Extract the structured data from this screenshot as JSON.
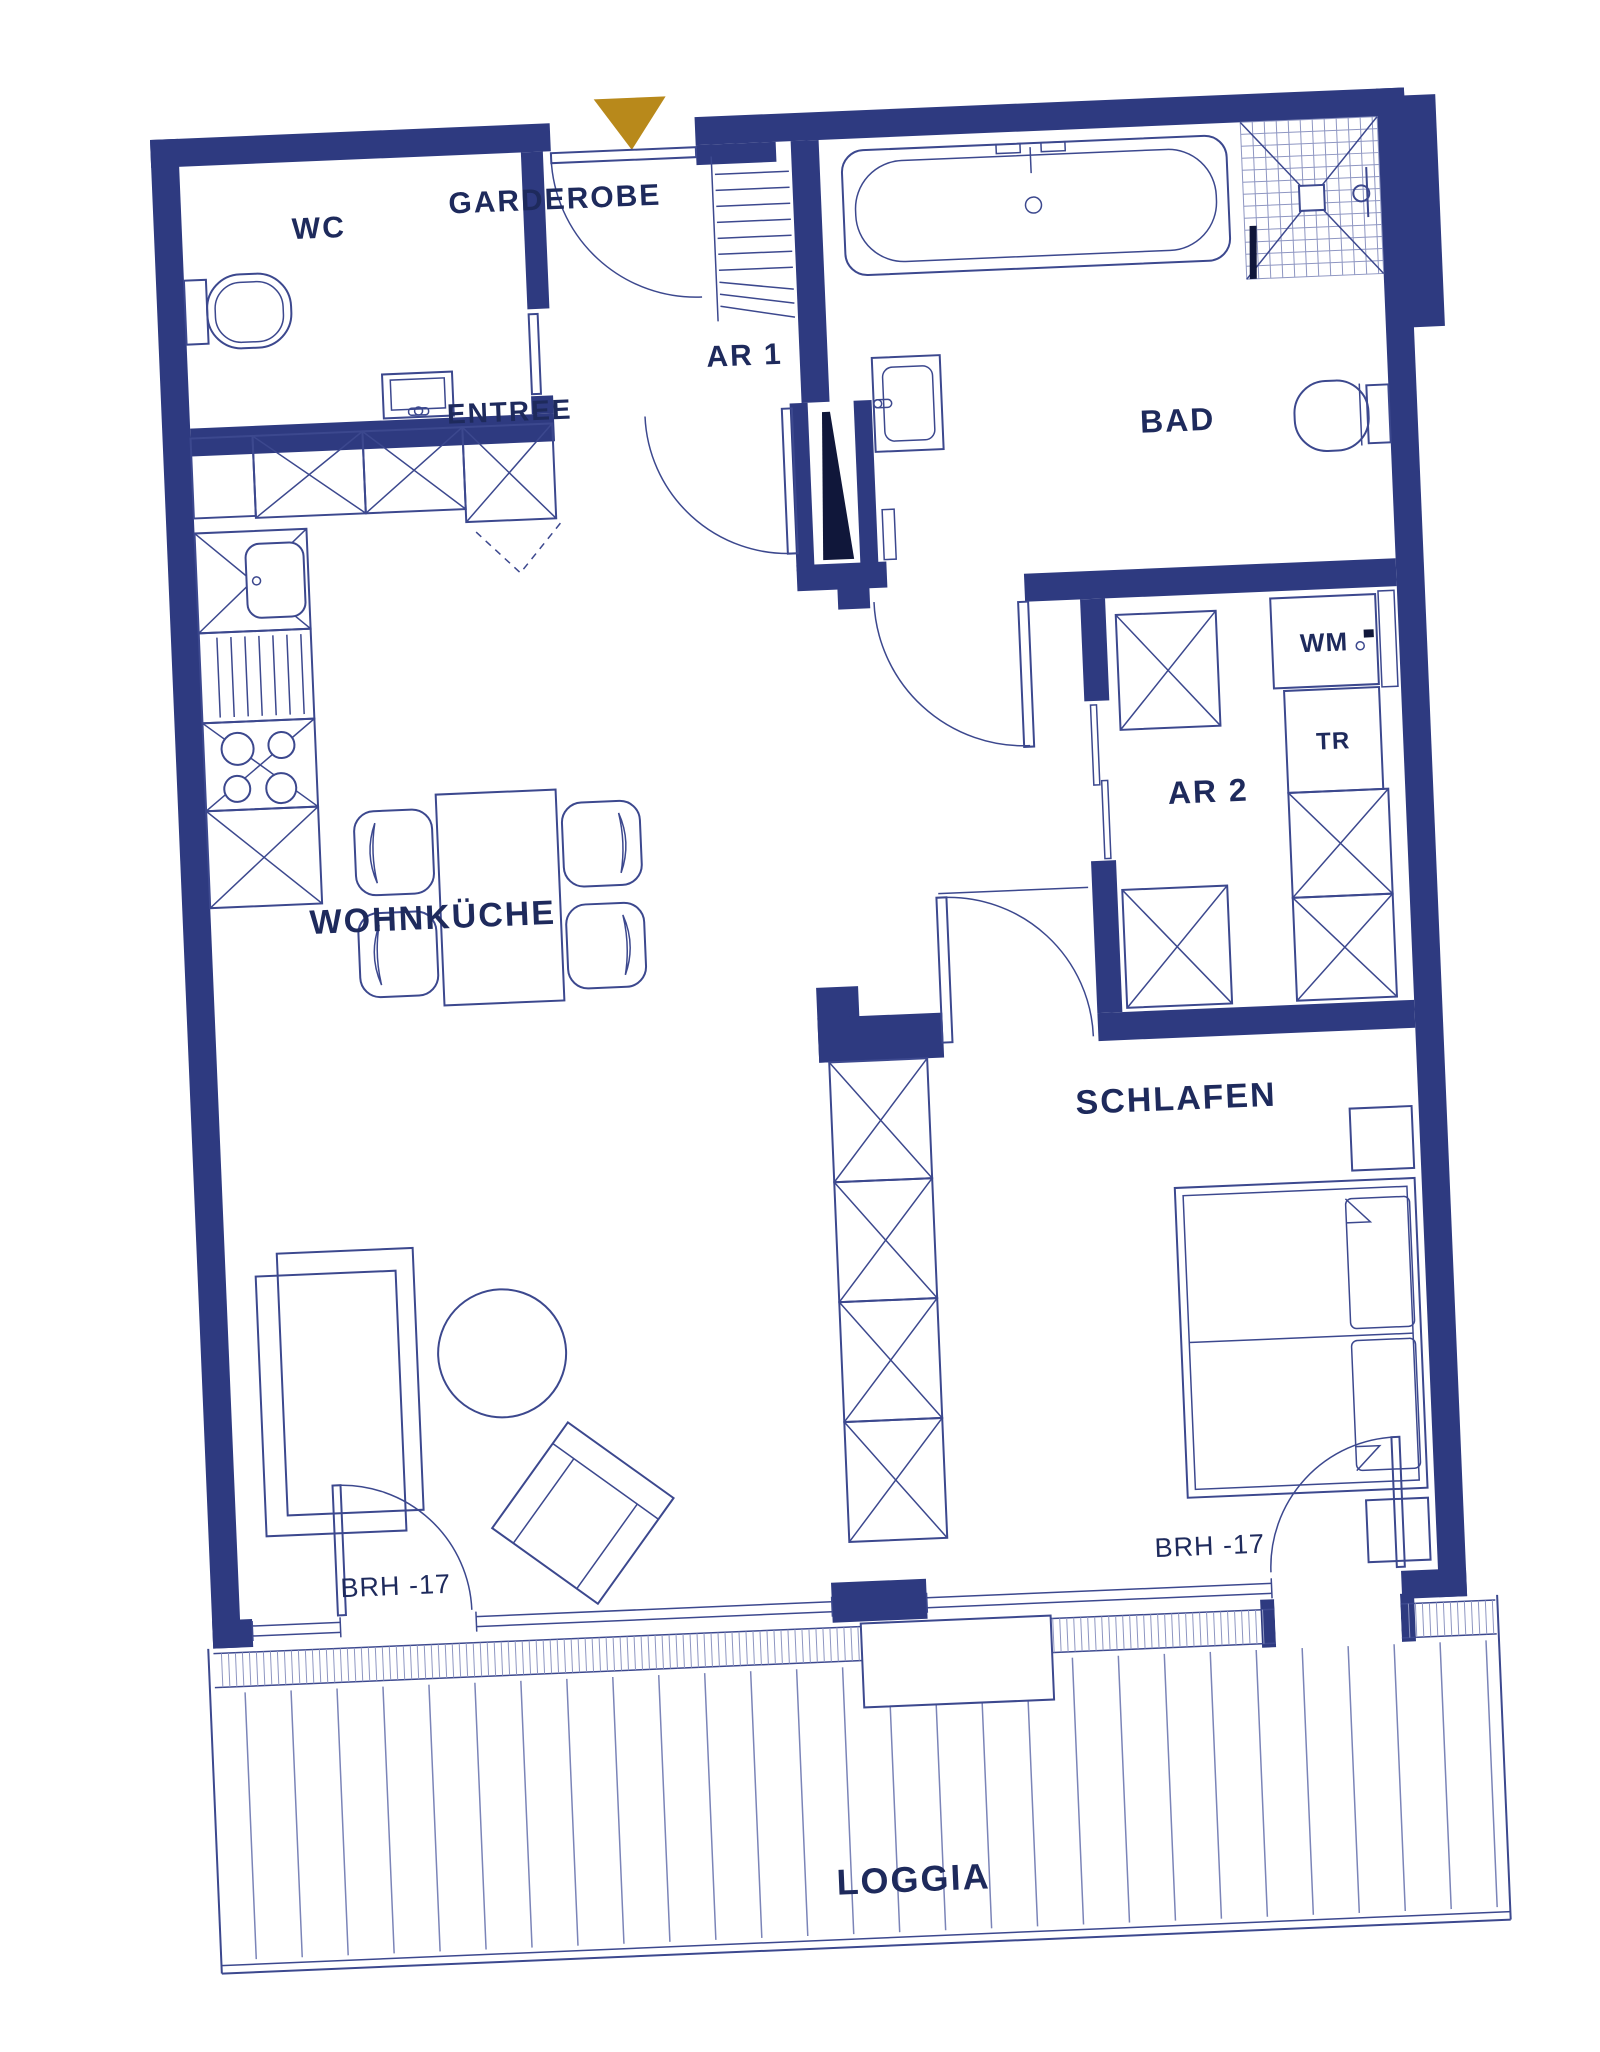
{
  "plan": {
    "type": "apartment-floor-plan",
    "rooms": {
      "wc": "WC",
      "garderobe": "GARDEROBE",
      "ar1": "AR 1",
      "entree": "ENTREE",
      "bad": "BAD",
      "ar2": "AR 2",
      "wohnkueche": "WOHNKÜCHE",
      "schlafen": "SCHLAFEN",
      "loggia": "LOGGIA"
    },
    "appliances": {
      "wm": "WM",
      "tr": "TR"
    },
    "annotations": {
      "brh_living": "BRH -17",
      "brh_bedroom": "BRH -17"
    },
    "markers": {
      "entrance_marker": "gold-triangle-entrance"
    },
    "colors": {
      "wall": "#2e3a80",
      "line": "#3c488e",
      "line_light": "#8e96c2",
      "text": "#1e2a5c",
      "accent_gold": "#b8891b",
      "background": "#ffffff"
    }
  }
}
